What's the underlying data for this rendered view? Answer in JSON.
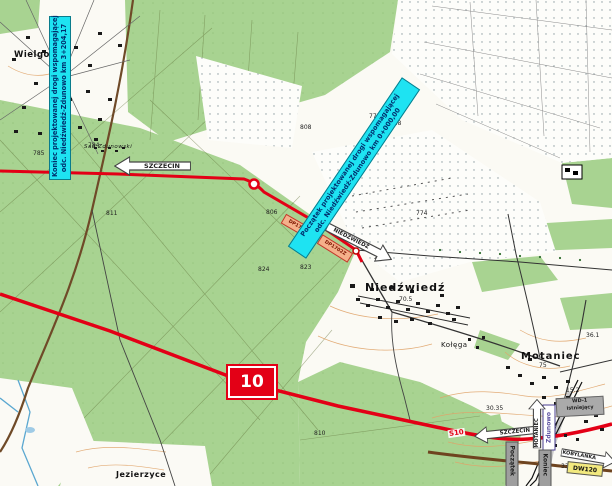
{
  "annotations": {
    "koniec": {
      "line1": "Koniec projektowanej drogi wspomagającej",
      "line2": "odc. Niedźwiedź-Zdunowo km 3+204,17"
    },
    "poczatek": {
      "line1": "Początek projektowanej drogi wspomagającej",
      "line2": "odc. Niedźwiedź-Zdunowo km 0+000,00"
    }
  },
  "arrows": {
    "szczecin_top": "SZCZECIN",
    "niedzwiedz": "NIEDŹWIEDŹ",
    "szczecin_bottom": "SZCZECIN",
    "motaniec": "MOTANIEC",
    "kobylanka": "KOBYLANKA"
  },
  "road_labels": {
    "shield": "10",
    "s10": "S10",
    "dw120": "DW120",
    "dp1702z_a": "DP1702Z",
    "dp1702z_b": "DP1702Z"
  },
  "boxes": {
    "wd1_line1": "WD-1",
    "wd1_line2": "istniejący",
    "poczatek_oprac": "Początek",
    "koniec_oprac": "Koniec"
  },
  "places": {
    "wielgowo": "Wielgowo",
    "niedzwiedz": "Niedźwiedź",
    "motaniec": "Motaniec",
    "kolega": "Kołęga",
    "jezierzyce": "Jezierzyce",
    "zdunowo": "Zdunowo",
    "sad_zdunowski": "Sad Zdunowski"
  },
  "spot_numbers": [
    "785",
    "784",
    "808",
    "811",
    "806",
    "775",
    "19.8",
    "774",
    "21.0",
    "70.5",
    "824",
    "823",
    "810",
    "75",
    "15.2",
    "36.1",
    "30.35",
    "33"
  ],
  "colors": {
    "annotation_cyan": "#1ee3f2",
    "route_red": "#e30016",
    "forest_green": "#a8d391",
    "dp_label_orange": "#f5b08a",
    "dw120_yellow": "#f2e97e",
    "zdunowo_purple": "#5b4ea0"
  }
}
